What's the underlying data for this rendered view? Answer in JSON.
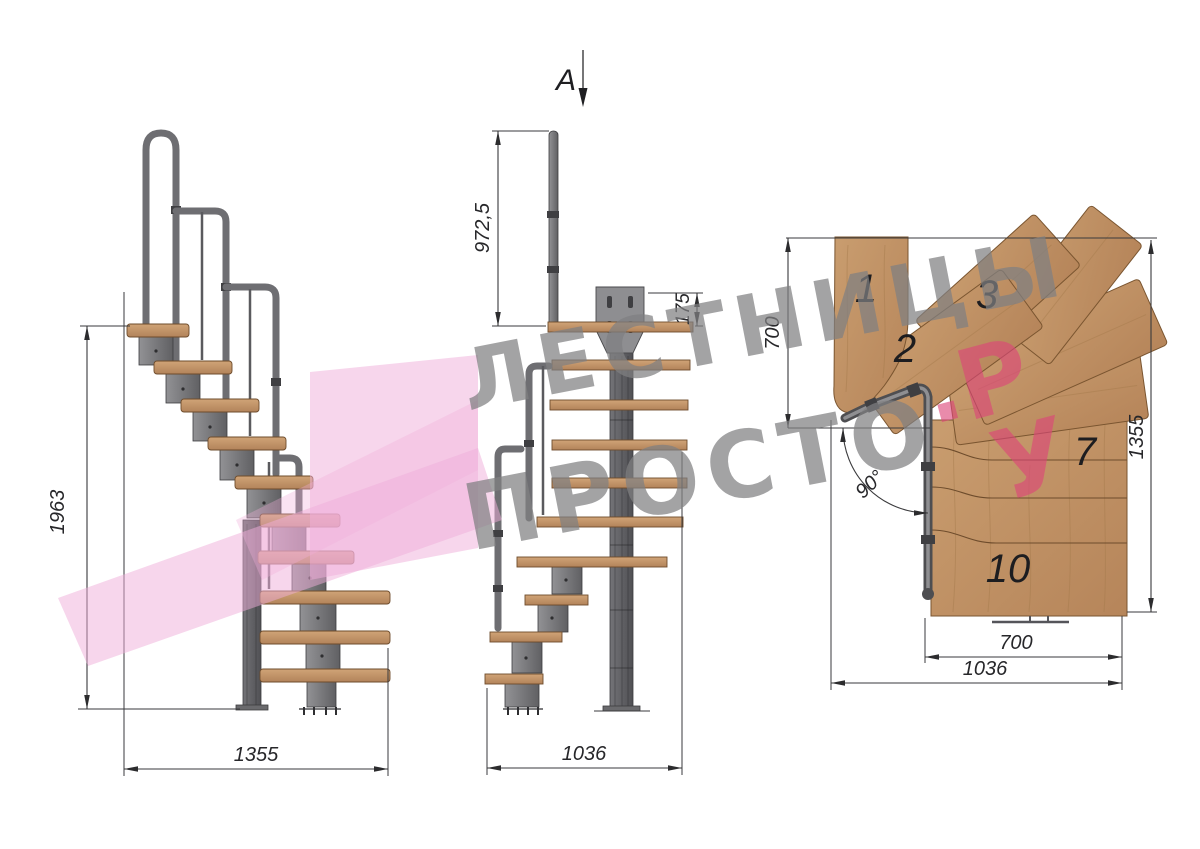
{
  "section_label": "A",
  "side_view": {
    "height_dim": "1963",
    "width_dim": "1355"
  },
  "front_view": {
    "post_height_dim": "972,5",
    "plate_offset_dim": "175",
    "width_dim": "1036"
  },
  "plan_view": {
    "upper_depth_dim": "700",
    "total_depth_dim": "1355",
    "angle_dim": "90°",
    "lower_width_dim": "700",
    "total_width_dim": "1036",
    "steps": {
      "s1": "1",
      "s2": "2",
      "s3": "3",
      "s7": "7",
      "s10": "10"
    }
  },
  "watermark": {
    "word1": "ЛЕСТНИЦЫ",
    "word2": "ПРОСТО",
    "dot": ".",
    "letter_r": "Р",
    "letter_u": "У"
  },
  "colors": {
    "wood": "#c29366",
    "wood_dark": "#9a6f45",
    "metal": "#77777a",
    "metal_dark": "#4c4c4f",
    "line": "#3a3a3c",
    "watermark_pink": "#f0aed9",
    "watermark_text_pink": "#dd4579",
    "watermark_gray": "#808082"
  }
}
